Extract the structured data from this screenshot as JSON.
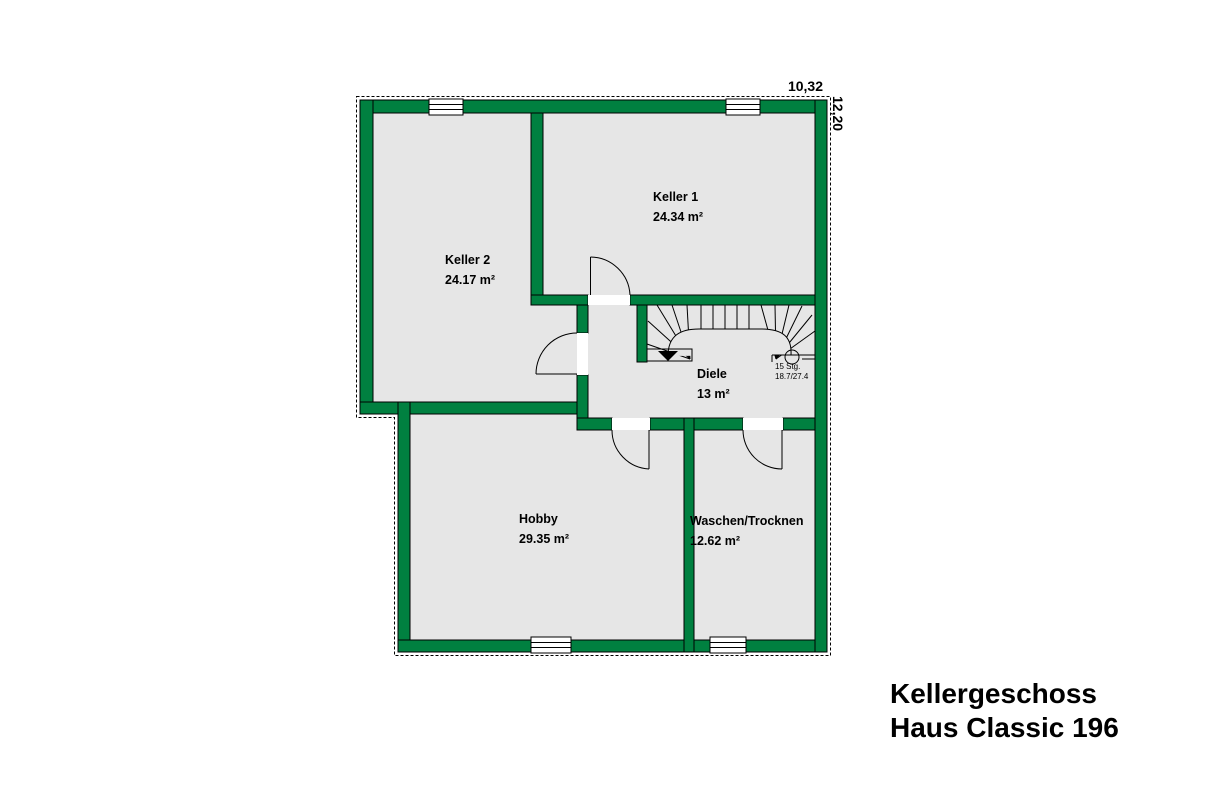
{
  "plan": {
    "dimensions": {
      "width": "10,32",
      "height": "12,20"
    },
    "rooms": {
      "keller1": {
        "name": "Keller 1",
        "area": "24.34 m²"
      },
      "keller2": {
        "name": "Keller 2",
        "area": "24.17 m²"
      },
      "diele": {
        "name": "Diele",
        "area": "13 m²"
      },
      "hobby": {
        "name": "Hobby",
        "area": "29.35 m²"
      },
      "waschen": {
        "name": "Waschen/Trocknen",
        "area": "12.62 m²"
      }
    },
    "stairs": {
      "steps": "15 Stg.",
      "rise_run": "18.7/27.4"
    },
    "title": {
      "line1": "Kellergeschoss",
      "line2": "Haus Classic 196"
    },
    "colors": {
      "wall_green": "#008040",
      "floor_gray": "#e6e6e6",
      "outline": "#000000"
    }
  }
}
